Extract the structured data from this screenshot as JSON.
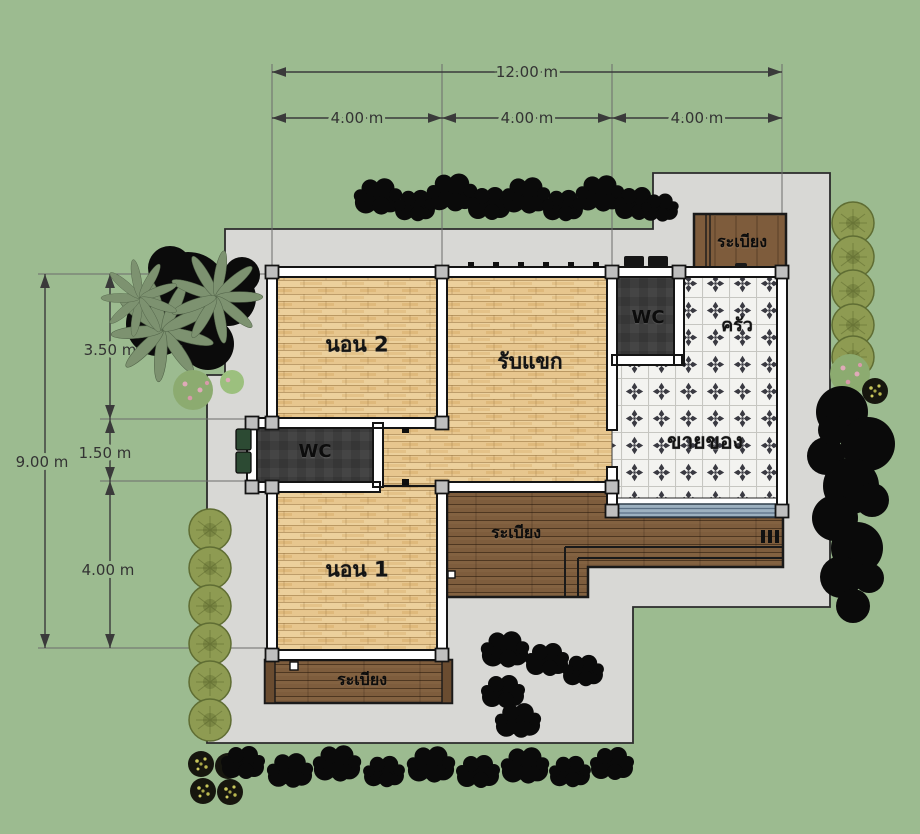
{
  "plan": {
    "type": "house-floor-plan",
    "dimensions": {
      "top_total": "12.00 m",
      "top_segments": [
        "4.00 m",
        "4.00 m",
        "4.00 m"
      ],
      "left_total": "9.00 m",
      "left_segments": [
        "3.50 m",
        "1.50 m",
        "4.00 m"
      ]
    },
    "rooms": {
      "bedroom2": "นอน 2",
      "living": "รับแขก",
      "wc_top": "WC",
      "kitchen": "ครัว",
      "shop": "ขายของ",
      "wc_middle": "WC",
      "bedroom1": "นอน 1",
      "balcony_top": "ระเบียง",
      "balcony_middle": "ระเบียง",
      "balcony_bottom": "ระเบียง"
    },
    "colors": {
      "grass": "#9cbb90",
      "concrete": "#d8d8d5",
      "wood_floor": "#e7c68e",
      "deck_wood": "#7e5d3d",
      "tile": "#f3f3f0",
      "tile_motif": "#3a3a42",
      "wc_floor": "#3d3d3d",
      "window_glass": "#9db1c0",
      "dimension_line": "#3a3a3a",
      "bush": "#8e9b52",
      "tree": "#0a0a0a"
    }
  }
}
